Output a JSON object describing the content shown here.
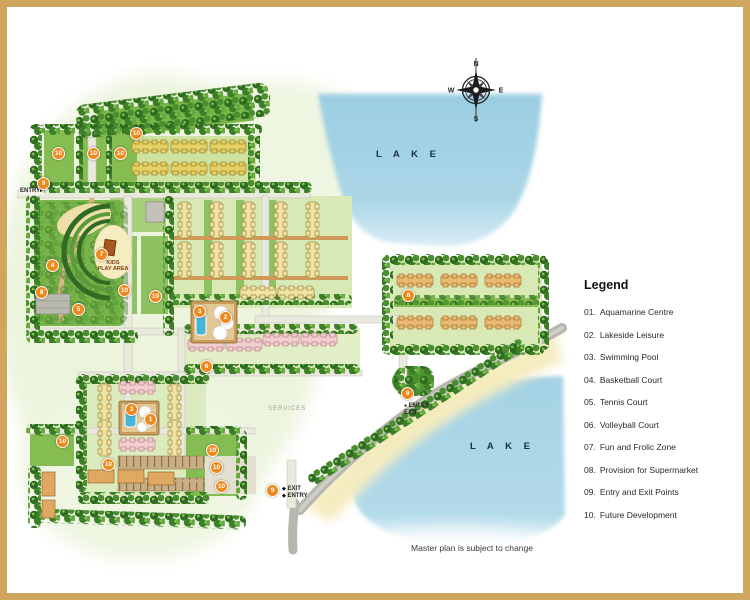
{
  "page": {
    "note": "Master plan is subject to change"
  },
  "compass": {
    "n": "N",
    "s": "S",
    "e": "E",
    "w": "W"
  },
  "labels": {
    "lake_top": "L A K E",
    "lake_bottom": "L A K E",
    "entry_left": "ENTRY",
    "exit_bottom_1": "EXIT",
    "exit_bottom_2": "ENTRY",
    "entry_mid_1": "ENTRY",
    "entry_mid_2": "EXIT",
    "kids_play_1": "KIDS",
    "kids_play_2": "PLAY AREA",
    "services": "SERVICES"
  },
  "legend": {
    "title": "Legend",
    "items": [
      {
        "num": "01.",
        "label": "Aquamarine Centre"
      },
      {
        "num": "02.",
        "label": "Lakeside Leisure"
      },
      {
        "num": "03.",
        "label": "Swimming Pool"
      },
      {
        "num": "04.",
        "label": "Basketball Court"
      },
      {
        "num": "05.",
        "label": "Tennis Court"
      },
      {
        "num": "06.",
        "label": "Volleyball Court"
      },
      {
        "num": "07.",
        "label": "Fun and Frolic Zone"
      },
      {
        "num": "08.",
        "label": "Provision for Supermarket"
      },
      {
        "num": "09.",
        "label": "Entry and Exit Points"
      },
      {
        "num": "10.",
        "label": "Future Development"
      }
    ]
  },
  "markers": [
    {
      "n": "10",
      "x": 58,
      "y": 153
    },
    {
      "n": "10",
      "x": 93,
      "y": 153
    },
    {
      "n": "10",
      "x": 120,
      "y": 153
    },
    {
      "n": "10",
      "x": 136,
      "y": 133
    },
    {
      "n": "9",
      "x": 43,
      "y": 183
    },
    {
      "n": "7",
      "x": 101,
      "y": 254
    },
    {
      "n": "4",
      "x": 52,
      "y": 265
    },
    {
      "n": "8",
      "x": 41,
      "y": 292
    },
    {
      "n": "5",
      "x": 78,
      "y": 309
    },
    {
      "n": "10",
      "x": 124,
      "y": 290
    },
    {
      "n": "10",
      "x": 155,
      "y": 296
    },
    {
      "n": "3",
      "x": 199,
      "y": 311
    },
    {
      "n": "2",
      "x": 225,
      "y": 317
    },
    {
      "n": "6",
      "x": 206,
      "y": 366
    },
    {
      "n": "8",
      "x": 408,
      "y": 295
    },
    {
      "n": "3",
      "x": 131,
      "y": 409
    },
    {
      "n": "1",
      "x": 150,
      "y": 419
    },
    {
      "n": "10",
      "x": 212,
      "y": 450
    },
    {
      "n": "10",
      "x": 216,
      "y": 467
    },
    {
      "n": "10",
      "x": 221,
      "y": 486
    },
    {
      "n": "9",
      "x": 272,
      "y": 490
    },
    {
      "n": "9",
      "x": 407,
      "y": 393
    },
    {
      "n": "10",
      "x": 62,
      "y": 441
    },
    {
      "n": "10",
      "x": 108,
      "y": 464
    }
  ],
  "colors": {
    "frame": "#d0a55e",
    "lake": "#a6d2e2",
    "marker": "#ee8a1d"
  }
}
